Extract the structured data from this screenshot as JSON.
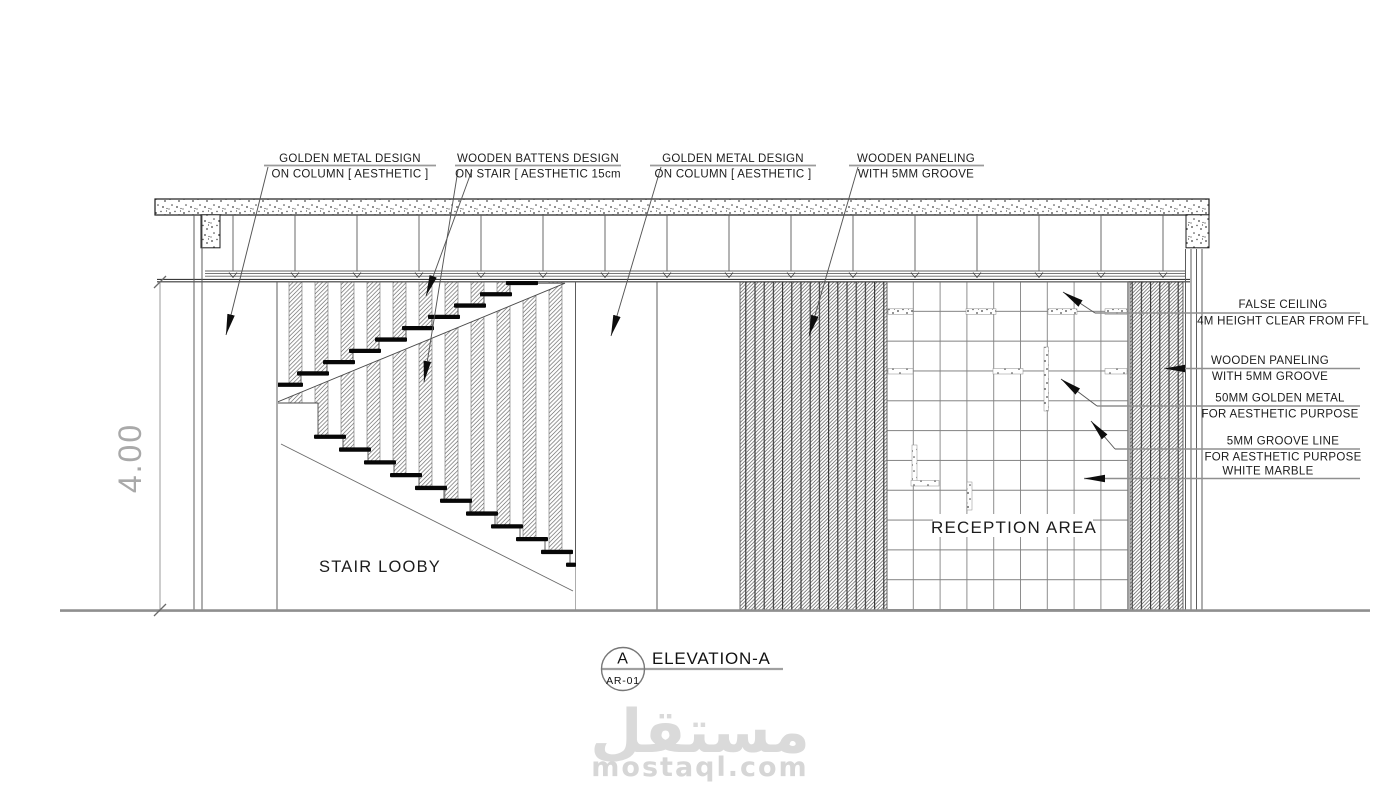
{
  "drawing": {
    "top_labels": [
      {
        "line1": "GOLDEN METAL DESIGN",
        "line2": "ON COLUMN [ AESTHETIC ]"
      },
      {
        "line1": "WOODEN BATTENS DESIGN",
        "line2": "ON STAIR [ AESTHETIC 15cm"
      },
      {
        "line1": "GOLDEN METAL DESIGN",
        "line2": "ON COLUMN [ AESTHETIC ]"
      },
      {
        "line1": "WOODEN PANELING",
        "line2": "WITH 5MM GROOVE"
      }
    ],
    "right_labels": [
      {
        "line1": "FALSE CEILING",
        "line2": "4M HEIGHT CLEAR FROM FFL"
      },
      {
        "line1": "WOODEN PANELING",
        "line2": "WITH 5MM GROOVE"
      },
      {
        "line1": "50MM GOLDEN METAL",
        "line2": "FOR AESTHETIC PURPOSE"
      },
      {
        "line1": "5MM GROOVE LINE",
        "line2": "FOR AESTHETIC PURPOSE"
      },
      {
        "line1": "WHITE MARBLE",
        "line2": ""
      }
    ],
    "areas": {
      "stair": "STAIR LOOBY",
      "reception": "RECEPTION AREA"
    },
    "dimension": {
      "height": "4.00"
    },
    "title": {
      "bubble_letter": "A",
      "bubble_ref": "AR-01",
      "name": "ELEVATION-A"
    },
    "watermark": {
      "arabic": "مستقل",
      "latin": "mostaql.com"
    },
    "colors": {
      "line_dark": "#2f2f2f",
      "line_gray": "#9a9a9a",
      "watermark": "#d9d9d9"
    }
  }
}
